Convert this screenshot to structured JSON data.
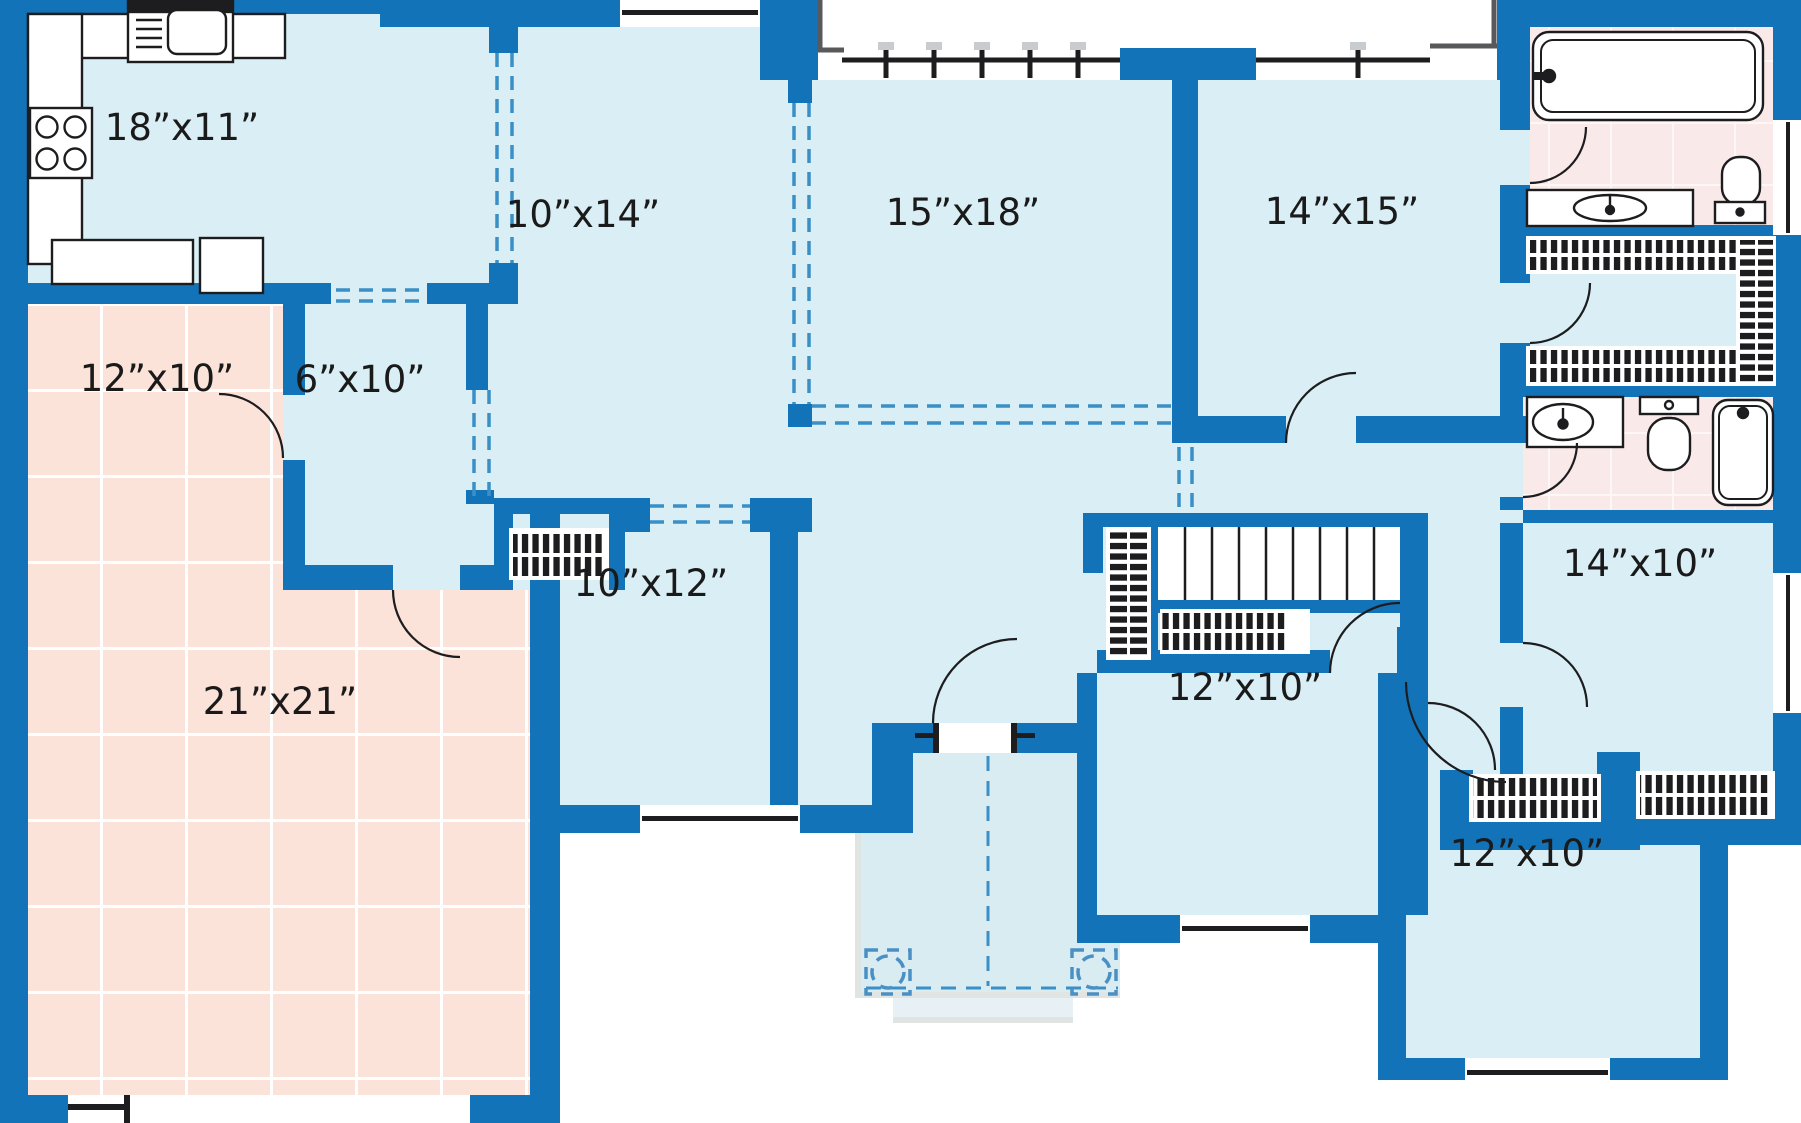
{
  "plan": {
    "title": "single-story house floor plan",
    "rooms": [
      {
        "id": "kitchen",
        "label": "18”x11”"
      },
      {
        "id": "living-room",
        "label": "10”x14”"
      },
      {
        "id": "family-room",
        "label": "15”x18”"
      },
      {
        "id": "master-bedroom",
        "label": "14”x15”"
      },
      {
        "id": "storage-room",
        "label": "12”x10”"
      },
      {
        "id": "mudroom",
        "label": "6”x10”"
      },
      {
        "id": "study",
        "label": "10”x12”"
      },
      {
        "id": "garage",
        "label": "21”x21”"
      },
      {
        "id": "bedroom-center",
        "label": "12”x10”"
      },
      {
        "id": "bedroom-east",
        "label": "14”x10”"
      },
      {
        "id": "bedroom-southeast",
        "label": "12”x10”"
      }
    ],
    "colors": {
      "wall": "#1273b9",
      "floor": "#d9eef5",
      "tile_floor": "#fce3da",
      "bath_floor": "#f9e9e8",
      "dash_line": "#3a8fc7",
      "fixture_outline": "#1d1d1f",
      "porch_outline": "#58595b",
      "post_cap": "#c8cccf"
    },
    "fixtures": [
      "stove-icon",
      "kitchen-sink-icon",
      "refrigerator-icon",
      "counter-icon",
      "bathtub-icon",
      "toilet-icon",
      "vanity-sink-icon",
      "staircase-icon",
      "closet-rod-icon",
      "door-swing-icon",
      "window-icon",
      "porch-railing-icon",
      "porch-post-icon",
      "garage-door-icon"
    ]
  }
}
